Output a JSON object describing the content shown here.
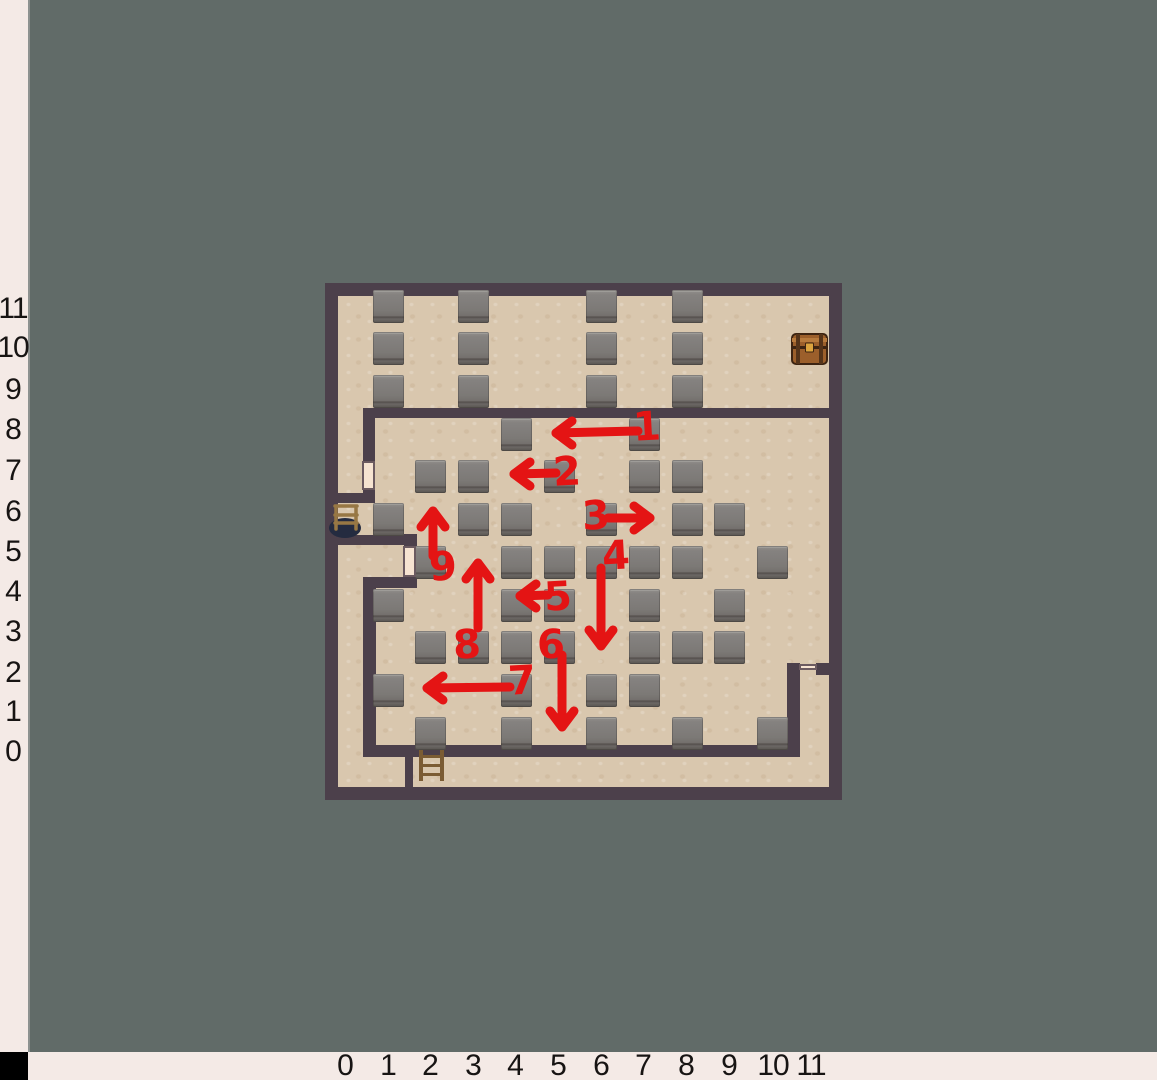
{
  "colors": {
    "background": "#616b68",
    "ruler_bg": "#f4eae6",
    "ruler_text": "#171413",
    "corner": "#000000",
    "wall": "#4c404b",
    "floor": "#d9c7ae",
    "door": "#f6e3d1",
    "block_gray": "#7c7976",
    "arrow_red": "#e41414",
    "chest_brown": "#9c5f2b",
    "chest_gold": "#dca43e",
    "ladder_wood": "#7b5c34",
    "chair_wood": "#977744",
    "chair_shadow": "#242b40"
  },
  "left_ruler": {
    "labels": [
      {
        "text": "11",
        "y": 309
      },
      {
        "text": "10",
        "y": 348
      },
      {
        "text": "9",
        "y": 390
      },
      {
        "text": "8",
        "y": 430
      },
      {
        "text": "7",
        "y": 471
      },
      {
        "text": "6",
        "y": 512
      },
      {
        "text": "5",
        "y": 552
      },
      {
        "text": "4",
        "y": 592
      },
      {
        "text": "3",
        "y": 632
      },
      {
        "text": "2",
        "y": 673
      },
      {
        "text": "1",
        "y": 712
      },
      {
        "text": "0",
        "y": 752
      }
    ]
  },
  "bottom_ruler": {
    "labels": [
      {
        "text": "0",
        "x": 345
      },
      {
        "text": "1",
        "x": 388
      },
      {
        "text": "2",
        "x": 430
      },
      {
        "text": "3",
        "x": 473
      },
      {
        "text": "4",
        "x": 515
      },
      {
        "text": "5",
        "x": 558
      },
      {
        "text": "6",
        "x": 601
      },
      {
        "text": "7",
        "x": 643
      },
      {
        "text": "8",
        "x": 686
      },
      {
        "text": "9",
        "x": 729
      },
      {
        "text": "10",
        "x": 773
      },
      {
        "text": "11",
        "x": 811
      }
    ]
  },
  "map": {
    "x": 325,
    "y": 283,
    "w": 517,
    "h": 517,
    "geom": {
      "ox": 330,
      "oy": 802,
      "tile": 42.7,
      "bw": 31,
      "bh": 33
    },
    "blocks": [
      [
        1,
        11
      ],
      [
        1,
        10
      ],
      [
        1,
        9
      ],
      [
        3,
        11
      ],
      [
        3,
        10
      ],
      [
        3,
        9
      ],
      [
        6,
        11
      ],
      [
        6,
        10
      ],
      [
        6,
        9
      ],
      [
        8,
        11
      ],
      [
        8,
        10
      ],
      [
        8,
        9
      ],
      [
        4,
        8
      ],
      [
        7,
        8
      ],
      [
        2,
        7
      ],
      [
        3,
        7
      ],
      [
        5,
        7
      ],
      [
        7,
        7
      ],
      [
        8,
        7
      ],
      [
        1,
        6
      ],
      [
        3,
        6
      ],
      [
        4,
        6
      ],
      [
        6,
        6
      ],
      [
        8,
        6
      ],
      [
        9,
        6
      ],
      [
        2,
        5
      ],
      [
        4,
        5
      ],
      [
        5,
        5
      ],
      [
        6,
        5
      ],
      [
        7,
        5
      ],
      [
        8,
        5
      ],
      [
        10,
        5
      ],
      [
        1,
        4
      ],
      [
        4,
        4
      ],
      [
        5,
        4
      ],
      [
        7,
        4
      ],
      [
        9,
        4
      ],
      [
        2,
        3
      ],
      [
        3,
        3
      ],
      [
        4,
        3
      ],
      [
        5,
        3
      ],
      [
        7,
        3
      ],
      [
        8,
        3
      ],
      [
        9,
        3
      ],
      [
        1,
        2
      ],
      [
        4,
        2
      ],
      [
        6,
        2
      ],
      [
        7,
        2
      ],
      [
        2,
        1
      ],
      [
        4,
        1
      ],
      [
        6,
        1
      ],
      [
        8,
        1
      ],
      [
        10,
        1
      ]
    ],
    "walls": [
      {
        "x": 363,
        "y": 408,
        "w": 466,
        "h": 10
      },
      {
        "x": 363,
        "y": 408,
        "w": 12,
        "h": 57
      },
      {
        "x": 363,
        "y": 487,
        "w": 12,
        "h": 10
      },
      {
        "x": 338,
        "y": 493,
        "w": 37,
        "h": 10
      },
      {
        "x": 338,
        "y": 535,
        "w": 79,
        "h": 10
      },
      {
        "x": 404,
        "y": 534,
        "w": 13,
        "h": 46
      },
      {
        "x": 363,
        "y": 577,
        "w": 54,
        "h": 11
      },
      {
        "x": 363,
        "y": 585,
        "w": 13,
        "h": 172
      },
      {
        "x": 363,
        "y": 745,
        "w": 437,
        "h": 12
      },
      {
        "x": 787,
        "y": 663,
        "w": 13,
        "h": 94
      },
      {
        "x": 816,
        "y": 663,
        "w": 13,
        "h": 12
      },
      {
        "x": 405,
        "y": 757,
        "w": 8,
        "h": 32
      }
    ],
    "doors": [
      {
        "name": "door-left-upper",
        "x": 362,
        "y": 461,
        "w": 13,
        "h": 29
      },
      {
        "name": "door-left-lower",
        "x": 403,
        "y": 546,
        "w": 13,
        "h": 31
      },
      {
        "name": "door-notch",
        "x": 799,
        "y": 664,
        "w": 18,
        "h": 6
      }
    ],
    "objects": [
      {
        "name": "treasure-chest",
        "x": 791,
        "y": 332,
        "w": 37,
        "h": 34
      },
      {
        "name": "chair",
        "x": 328,
        "y": 503,
        "w": 36,
        "h": 36
      },
      {
        "name": "ladder",
        "x": 417,
        "y": 750,
        "w": 29,
        "h": 31
      }
    ]
  },
  "arrows": [
    {
      "label": "1",
      "lx": 647,
      "ly": 427,
      "x1": 638,
      "y1": 431,
      "x2": 556,
      "y2": 433,
      "dir": "left"
    },
    {
      "label": "2",
      "lx": 567,
      "ly": 472,
      "x1": 556,
      "y1": 473,
      "x2": 514,
      "y2": 474,
      "dir": "left"
    },
    {
      "label": "3",
      "lx": 596,
      "ly": 516,
      "x1": 608,
      "y1": 518,
      "x2": 650,
      "y2": 518,
      "dir": "right"
    },
    {
      "label": "4",
      "lx": 616,
      "ly": 556,
      "x1": 601,
      "y1": 568,
      "x2": 601,
      "y2": 646,
      "dir": "down"
    },
    {
      "label": "5",
      "lx": 558,
      "ly": 597,
      "x1": 548,
      "y1": 595,
      "x2": 520,
      "y2": 596,
      "dir": "left"
    },
    {
      "label": "6",
      "lx": 551,
      "ly": 645,
      "x1": 562,
      "y1": 655,
      "x2": 562,
      "y2": 727,
      "dir": "down"
    },
    {
      "label": "7",
      "lx": 522,
      "ly": 681,
      "x1": 510,
      "y1": 687,
      "x2": 427,
      "y2": 688,
      "dir": "left"
    },
    {
      "label": "8",
      "lx": 467,
      "ly": 645,
      "x1": 478,
      "y1": 628,
      "x2": 478,
      "y2": 563,
      "dir": "up"
    },
    {
      "label": "9",
      "lx": 443,
      "ly": 567,
      "x1": 433,
      "y1": 556,
      "x2": 433,
      "y2": 511,
      "dir": "up"
    }
  ]
}
